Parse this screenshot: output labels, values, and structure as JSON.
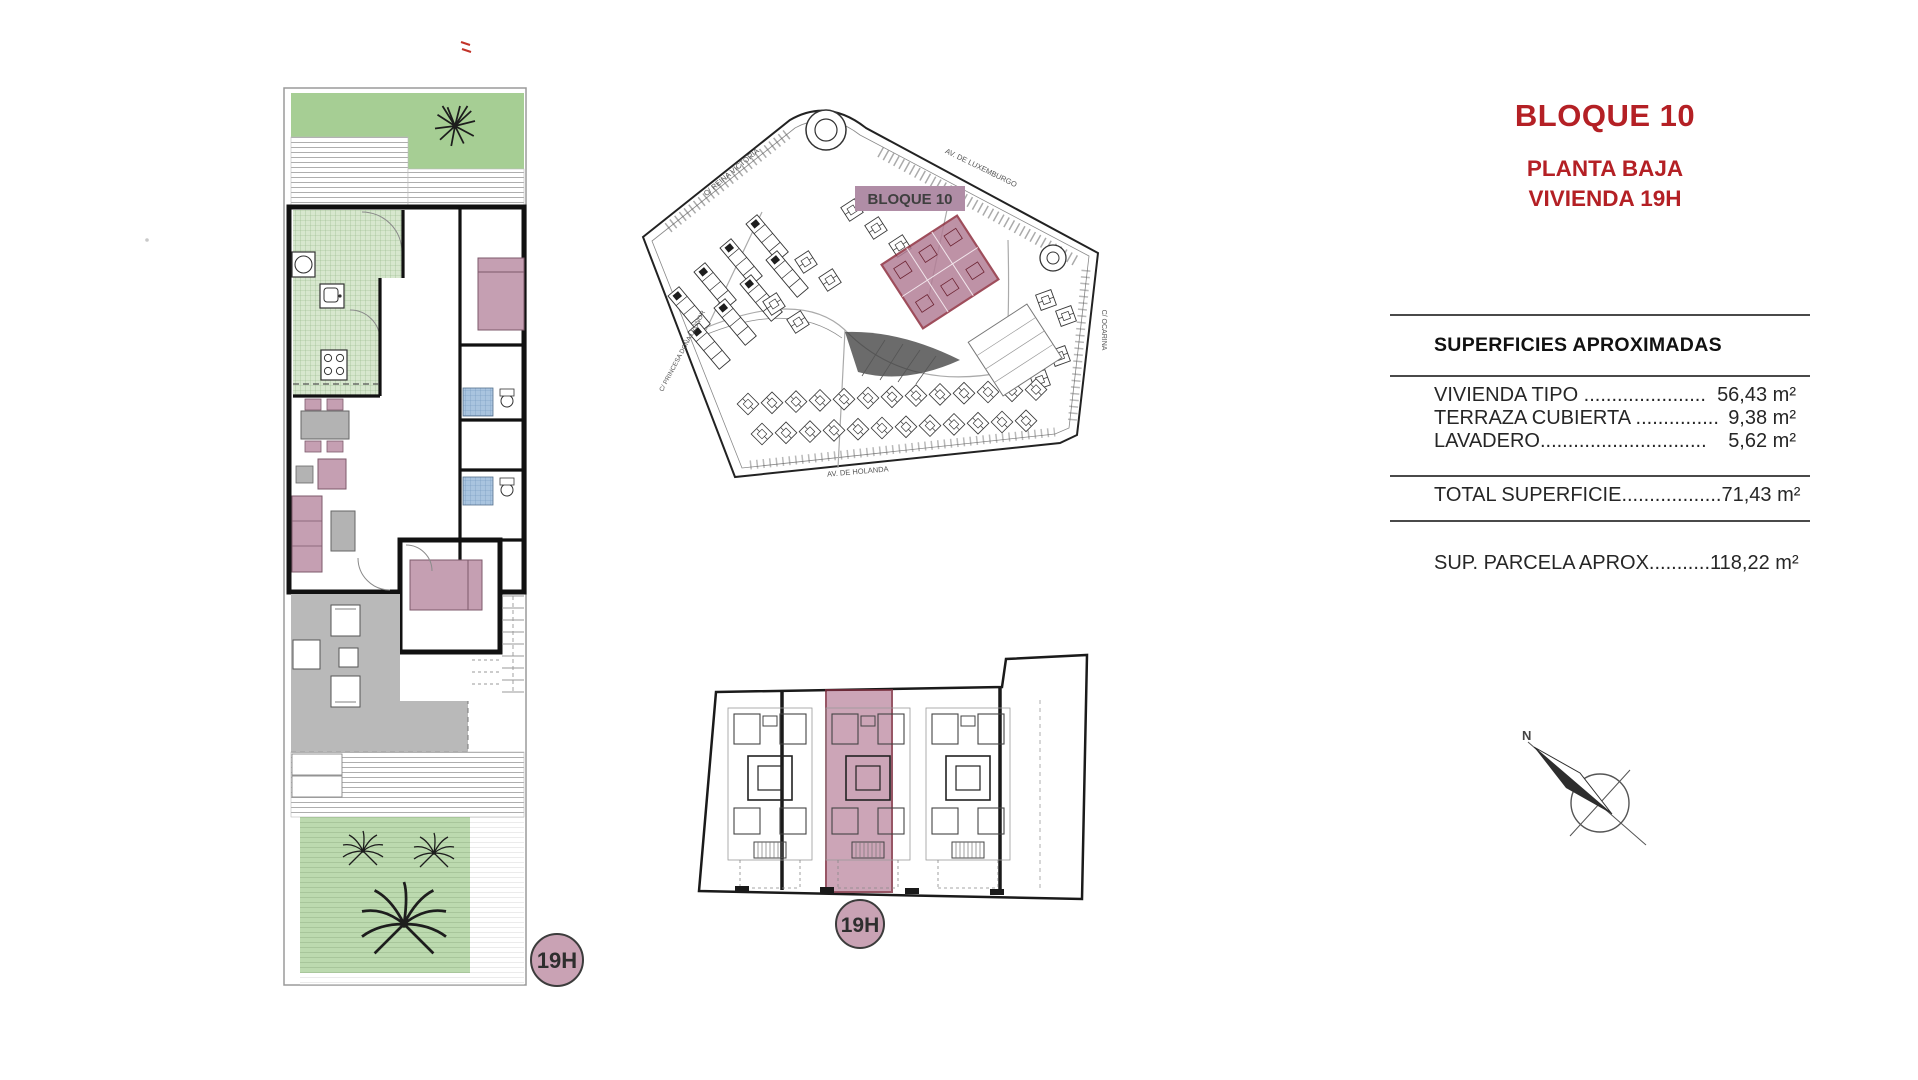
{
  "title_block": {
    "line1": "BLOQUE 10",
    "line2": "PLANTA BAJA",
    "line3": "VIVIENDA 19H",
    "accent_color": "#b42025"
  },
  "surfaces_table": {
    "heading": "SUPERFICIES APROXIMADAS",
    "rows": [
      {
        "label": "VIVIENDA TIPO ......................",
        "value": "56,43 m²"
      },
      {
        "label": "TERRAZA CUBIERTA ...............",
        "value": "9,38 m²"
      },
      {
        "label": "LAVADERO..............................",
        "value": "5,62 m²"
      }
    ],
    "total": {
      "label": "TOTAL SUPERFICIE..................",
      "value": "71,43 m²"
    },
    "parcel": {
      "label": "SUP. PARCELA APROX...........",
      "value": "118,22 m²"
    }
  },
  "site_plan": {
    "block_label": "BLOQUE 10",
    "streets": {
      "top_left": "C/ REINA VICTORIA",
      "top_right": "AV. DE LUXEMBURGO",
      "bottom": "AV. DE HOLANDA",
      "right": "C/ OCARINA",
      "left": "C/ PRINCESA DOÑA LEONOR"
    }
  },
  "badges": {
    "floor_plan_unit": "19H",
    "block_plan_unit": "19H"
  },
  "compass": {
    "north_label": "N"
  },
  "colors": {
    "accent_red": "#b42025",
    "garden_green": "#a6ce94",
    "mauve": "#c59fb2",
    "site_band": "#b08da6",
    "highlight_fill": "#b37f97",
    "highlight_border": "#8e2f3f",
    "bath_blue": "#a9c4df",
    "terrace_gray": "#b9b9b9",
    "badge_fill": "#c9a2b4"
  }
}
